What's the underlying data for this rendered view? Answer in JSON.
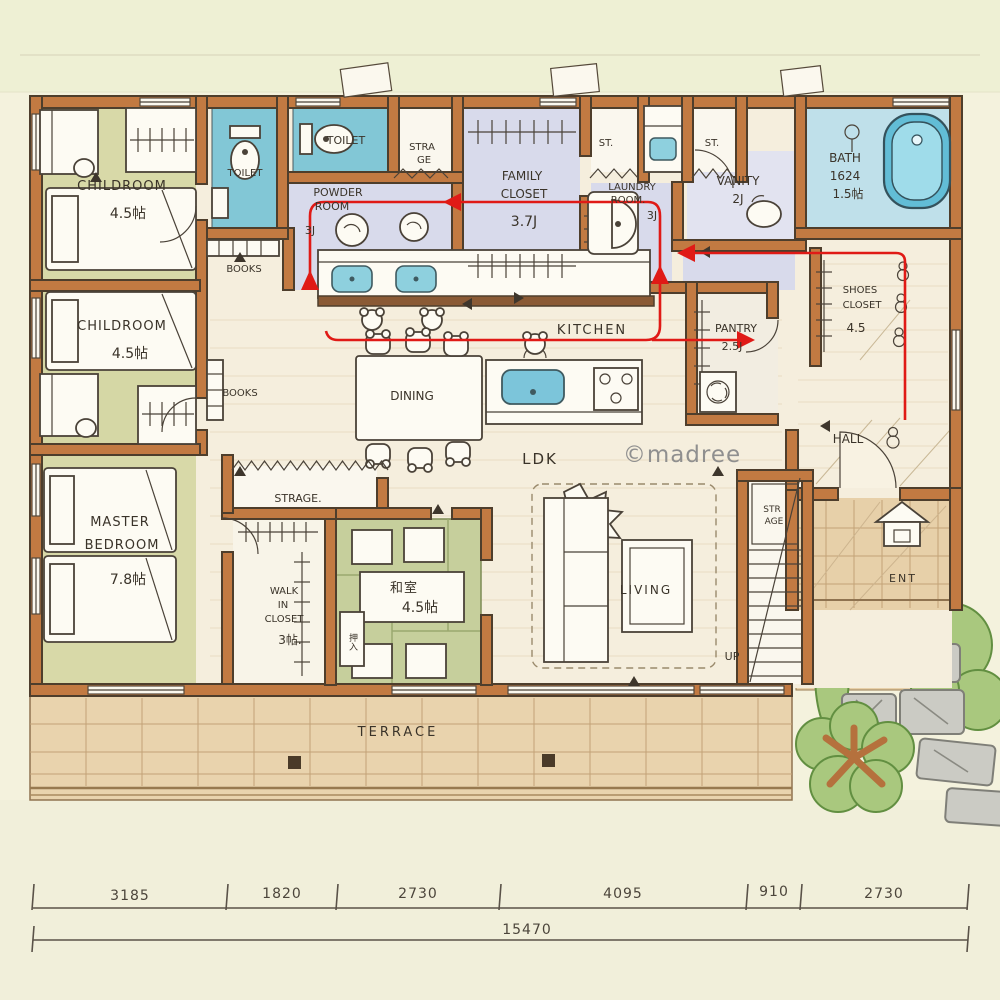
{
  "watermark": "©madree",
  "rooms": {
    "childroom1": {
      "name": "CHILDROOM",
      "size": "4.5帖"
    },
    "childroom2": {
      "name": "CHILDROOM",
      "size": "4.5帖"
    },
    "toilet1": {
      "name": "TOILET"
    },
    "toilet2": {
      "name": "TOILET"
    },
    "strage_top": {
      "line1": "STRA",
      "line2": "GE"
    },
    "family_closet": {
      "line1": "FAMILY",
      "line2": "CLOSET",
      "size": "3.7J"
    },
    "st1": {
      "name": "ST."
    },
    "st2": {
      "name": "ST."
    },
    "laundry": {
      "line1": "LAUNDRY",
      "line2": "ROOM.",
      "size": "3J"
    },
    "vanity": {
      "name": "VANITY",
      "size": "2J"
    },
    "bath": {
      "name": "BATH",
      "model": "1624",
      "size": "1.5帖"
    },
    "powder": {
      "line1": "POWDER",
      "line2": "ROOM",
      "size": "3J"
    },
    "books_top": {
      "name": "BOOKS"
    },
    "books_mid": {
      "name": "BOOKS"
    },
    "kitchen": {
      "name": "KITCHEN"
    },
    "pantry": {
      "name": "PANTRY",
      "size": "2.5J"
    },
    "shoes_closet": {
      "line1": "SHOES",
      "line2": "CLOSET",
      "size": "4.5"
    },
    "hall": {
      "name": "HALL"
    },
    "dining": {
      "name": "DINING"
    },
    "ldk": {
      "name": "LDK"
    },
    "master": {
      "line1": "MASTER",
      "line2": "BEDROOM",
      "size": "7.8帖"
    },
    "strage_mid": {
      "name": "STRAGE."
    },
    "wic": {
      "line1": "WALK",
      "line2": "IN",
      "line3": "CLOSET",
      "size": "3帖."
    },
    "tatami": {
      "name": "和室",
      "size": "4.5帖",
      "closet": "押入"
    },
    "living": {
      "name": "LIVING"
    },
    "stair_storage": {
      "line1": "STR",
      "line2": "AGE"
    },
    "up": {
      "name": "UP"
    },
    "ent": {
      "name": "ENT"
    },
    "terrace": {
      "name": "TERRACE"
    }
  },
  "dimensions": {
    "segments": [
      "3185",
      "1820",
      "2730",
      "4095",
      "910",
      "2730"
    ],
    "total": "15470"
  },
  "colors": {
    "wall": "#c27a42",
    "water_blue": "#82c7d6",
    "corridor_lavender": "#d8daeb",
    "room_olive": "#d8d9a8",
    "tatami_green": "#c6cf9c",
    "wood_cream": "#f5eedd",
    "terrace_tan": "#e9d3ad",
    "route_red": "#e01a16"
  }
}
